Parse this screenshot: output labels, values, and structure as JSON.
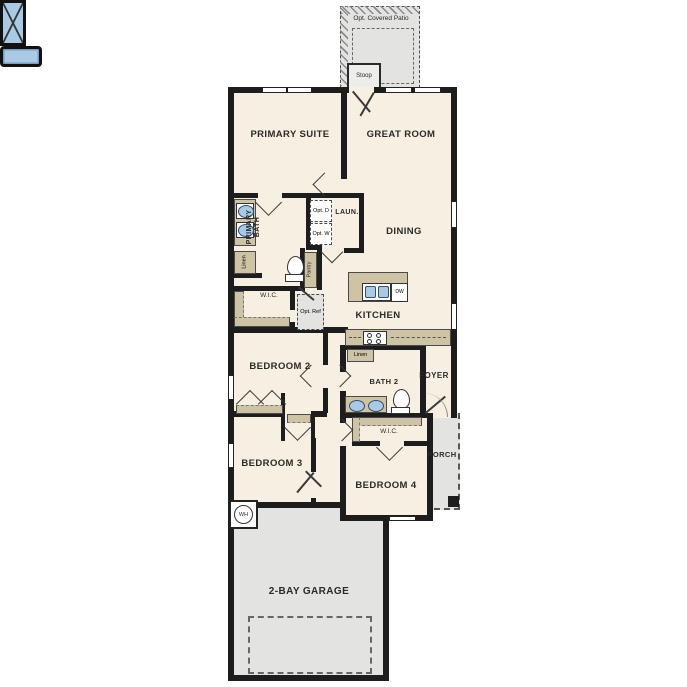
{
  "labels": {
    "patio": "Opt. Covered Patio",
    "stoop": "Stoop",
    "primary_suite": "PRIMARY SUITE",
    "great_room": "GREAT ROOM",
    "primary_bath": "PRIMARY BATH",
    "laundry": "LAUN.",
    "opt_dryer": "Opt. D",
    "opt_washer": "Opt. W",
    "linen_primary": "Linen",
    "pantry": "Pantry",
    "dining": "DINING",
    "wic_primary": "W.I.C.",
    "opt_ref": "Opt. Ref",
    "kitchen": "KITCHEN",
    "dishwasher": "DW",
    "bedroom2": "BEDROOM 2",
    "linen_bath2": "Linen",
    "bath2": "BATH 2",
    "foyer": "FOYER",
    "bedroom3": "BEDROOM 3",
    "wic_bed4": "W.I.C.",
    "bedroom4": "BEDROOM 4",
    "porch": "PORCH",
    "water_heater": "WH",
    "garage": "2-BAY GARAGE"
  },
  "colors": {
    "wall": "#1d1d1d",
    "floor": "#f7efe1",
    "optional_area": "#e3e3e1",
    "cabinetry": "#cfc3a6",
    "fixture_blue": "#a9c9e5"
  }
}
